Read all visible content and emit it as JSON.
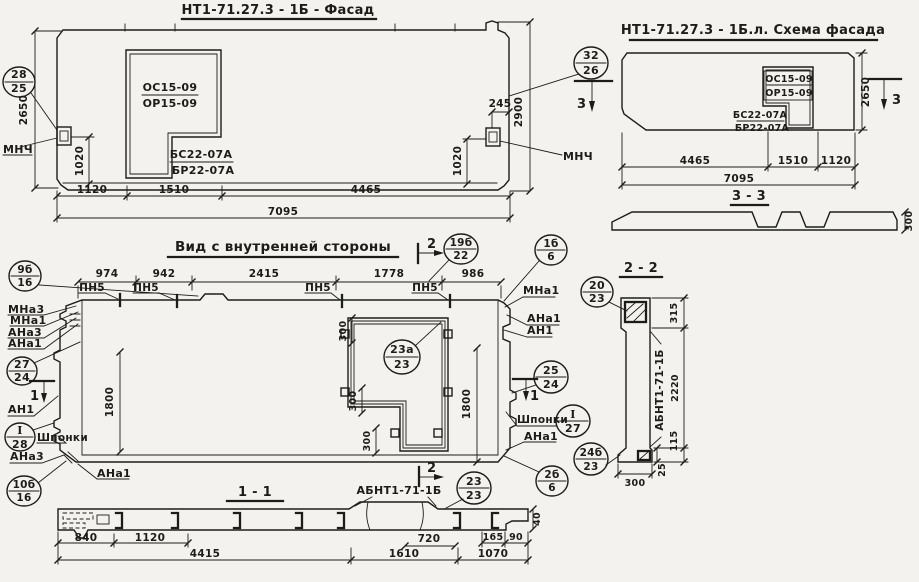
{
  "palette": {
    "paper": "#f3f2ee",
    "ink": "#1d1c19"
  },
  "facade": {
    "title": "НТ1-71.27.3 - 1Б - Фасад",
    "circle2825": {
      "top": "28",
      "bottom": "25"
    },
    "circle3226": {
      "top": "32",
      "bottom": "26"
    },
    "mnch": "МНЧ",
    "window": {
      "os": "ОС15-09",
      "orr": "ОР15-09",
      "bs": "БС22-07А",
      "br": "БР22-07А"
    },
    "dims": {
      "h2650": "2650",
      "h2900": "2900",
      "v1020": "1020",
      "w245": "245",
      "b1120": "1120",
      "b1510": "1510",
      "b4465": "4465",
      "total": "7095"
    }
  },
  "scheme": {
    "title": "НТ1-71.27.3 - 1Б.л. Схема фасада",
    "marker": "3",
    "window": {
      "os": "ОС15-09",
      "orr": "ОР15-09",
      "bs": "БС22-07А",
      "br": "БР22-07А"
    },
    "dims": {
      "h2650": "2650",
      "b4465": "4465",
      "b1510": "1510",
      "b1120": "1120",
      "total": "7095"
    },
    "section": {
      "title": "3 - 3",
      "d300": "300"
    }
  },
  "inner": {
    "title": "Вид с внутренней стороны",
    "marker2": "2",
    "marker1": "1",
    "pn5": "ПН5",
    "dims": {
      "d974": "974",
      "d942": "942",
      "d2415": "2415",
      "d1778": "1778",
      "d986": "986",
      "d1800": "1800",
      "d300": "300"
    },
    "circles": {
      "c9b16": {
        "top": "9б",
        "bottom": "16"
      },
      "c19b22": {
        "top": "19б",
        "bottom": "22"
      },
      "c1b6": {
        "top": "1б",
        "bottom": "6"
      },
      "c2724": {
        "top": "27",
        "bottom": "24"
      },
      "cI28": {
        "top": "I",
        "bottom": "28"
      },
      "c10b16": {
        "top": "10б",
        "bottom": "16"
      },
      "c23a23": {
        "top": "23а",
        "bottom": "23"
      },
      "c2524": {
        "top": "25",
        "bottom": "24"
      },
      "cI27": {
        "top": "I",
        "bottom": "27"
      },
      "c2b6": {
        "top": "2б",
        "bottom": "6"
      }
    },
    "labels": {
      "mna3": "МНа3",
      "mna1": "МНа1",
      "ana3": "АНа3",
      "ana1": "АНа1",
      "an1": "АН1",
      "shponki": "Шпонки"
    }
  },
  "s11": {
    "title": "1 - 1",
    "label": "АБНТ1-71-1Б",
    "circle2323": {
      "top": "23",
      "bottom": "23"
    },
    "dims": {
      "d840": "840",
      "d1120": "1120",
      "d4415": "4415",
      "d720": "720",
      "d1610": "1610",
      "d1070": "1070",
      "d165": "165",
      "d90": "90",
      "d40": "40"
    }
  },
  "s22": {
    "title": "2 - 2",
    "label": "АБНТ1-71-1Б",
    "circle2023": {
      "top": "20",
      "bottom": "23"
    },
    "circle24b23": {
      "top": "24б",
      "bottom": "23"
    },
    "dims": {
      "d315": "315",
      "d2220": "2220",
      "d115": "115",
      "d25": "25",
      "d300": "300"
    }
  }
}
